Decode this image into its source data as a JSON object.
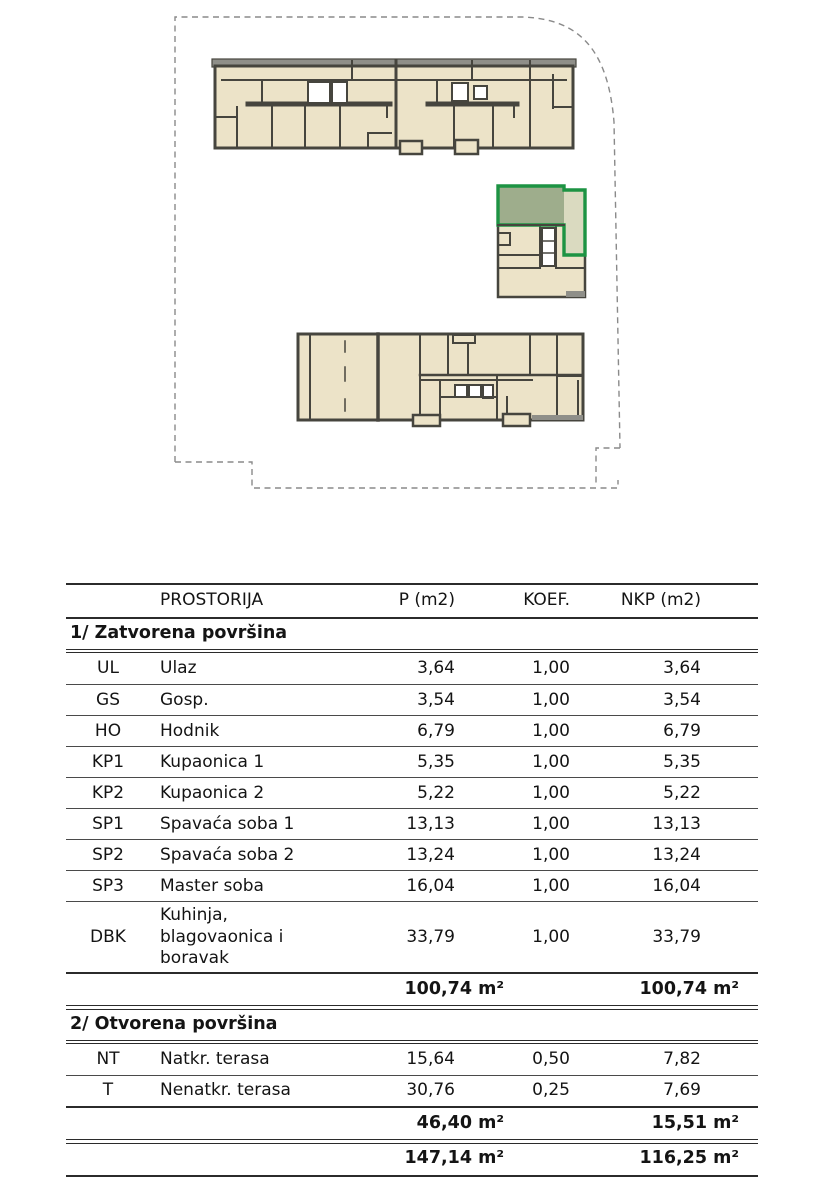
{
  "site_plan": {
    "colors": {
      "beige": "#ece3c8",
      "wall": "#46453e",
      "gray": "#8f8f89",
      "green": "#1d9343",
      "sage": "#9ead8c",
      "lightcol": "#dadac0",
      "boundary": "#8a8a8a"
    },
    "elements": {
      "boundary": "site-boundary-dashed",
      "north": "north-building-floorplan",
      "middle": "middle-building-floorplan",
      "highlight": "highlighted-unit",
      "south": "south-building-floorplan"
    }
  },
  "table": {
    "headers": {
      "prostorija": "PROSTORIJA",
      "p": "P (m2)",
      "koef": "KOEF.",
      "nkp": "NKP (m2)"
    },
    "sections": [
      {
        "title": "1/ Zatvorena površina",
        "rows": [
          {
            "code": "UL",
            "name": "Ulaz",
            "p": "3,64",
            "koef": "1,00",
            "nkp": "3,64"
          },
          {
            "code": "GS",
            "name": "Gosp.",
            "p": "3,54",
            "koef": "1,00",
            "nkp": "3,54"
          },
          {
            "code": "HO",
            "name": "Hodnik",
            "p": "6,79",
            "koef": "1,00",
            "nkp": "6,79"
          },
          {
            "code": "KP1",
            "name": "Kupaonica 1",
            "p": "5,35",
            "koef": "1,00",
            "nkp": "5,35"
          },
          {
            "code": "KP2",
            "name": "Kupaonica 2",
            "p": "5,22",
            "koef": "1,00",
            "nkp": "5,22"
          },
          {
            "code": "SP1",
            "name": "Spavaća soba 1",
            "p": "13,13",
            "koef": "1,00",
            "nkp": "13,13"
          },
          {
            "code": "SP2",
            "name": "Spavaća soba 2",
            "p": "13,24",
            "koef": "1,00",
            "nkp": "13,24"
          },
          {
            "code": "SP3",
            "name": "Master soba",
            "p": "16,04",
            "koef": "1,00",
            "nkp": "16,04"
          },
          {
            "code": "DBK",
            "name": "Kuhinja, blagovaonica i boravak",
            "p": "33,79",
            "koef": "1,00",
            "nkp": "33,79"
          }
        ],
        "subtotal": {
          "p": "100,74 m²",
          "nkp": "100,74 m²"
        }
      },
      {
        "title": "2/ Otvorena površina",
        "rows": [
          {
            "code": "NT",
            "name": "Natkr. terasa",
            "p": "15,64",
            "koef": "0,50",
            "nkp": "7,82"
          },
          {
            "code": "T",
            "name": "Nenatkr. terasa",
            "p": "30,76",
            "koef": "0,25",
            "nkp": "7,69"
          }
        ],
        "subtotal": {
          "p": "46,40 m²",
          "nkp": "15,51 m²"
        }
      }
    ],
    "total": {
      "p": "147,14 m²",
      "nkp": "116,25 m²"
    }
  }
}
